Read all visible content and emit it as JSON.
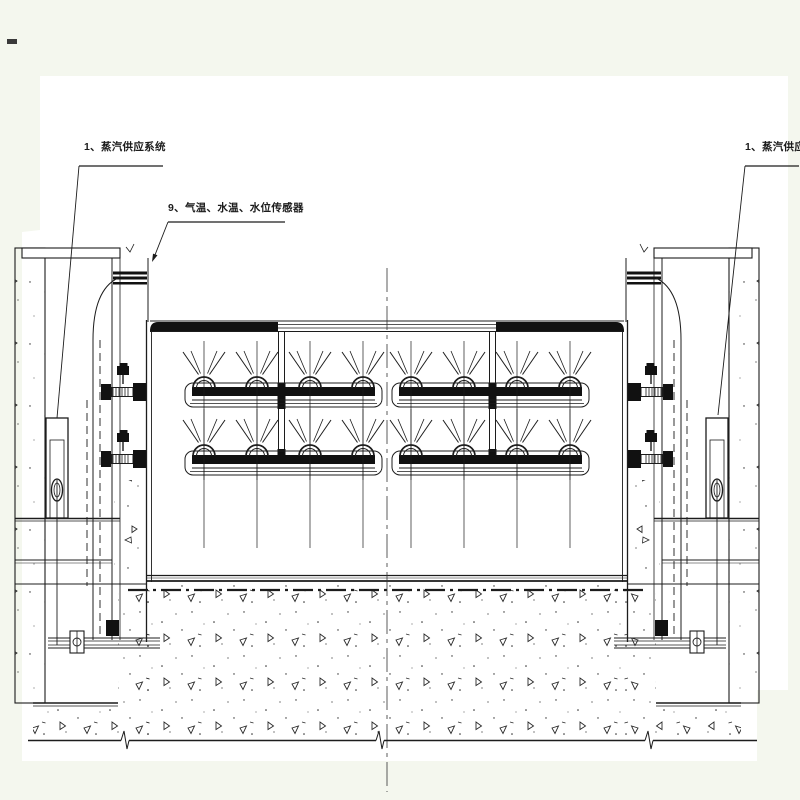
{
  "drawing": {
    "background_color": "#f4f7ee",
    "paper_color": "#ffffff",
    "line_color": "#1c1c1c",
    "labels": {
      "steam_supply_left": "1、蒸汽供应系统",
      "temp_water_level_sensors": "9、气温、水温、水位传感器",
      "steam_supply_right": "1、蒸汽供应系统"
    }
  }
}
